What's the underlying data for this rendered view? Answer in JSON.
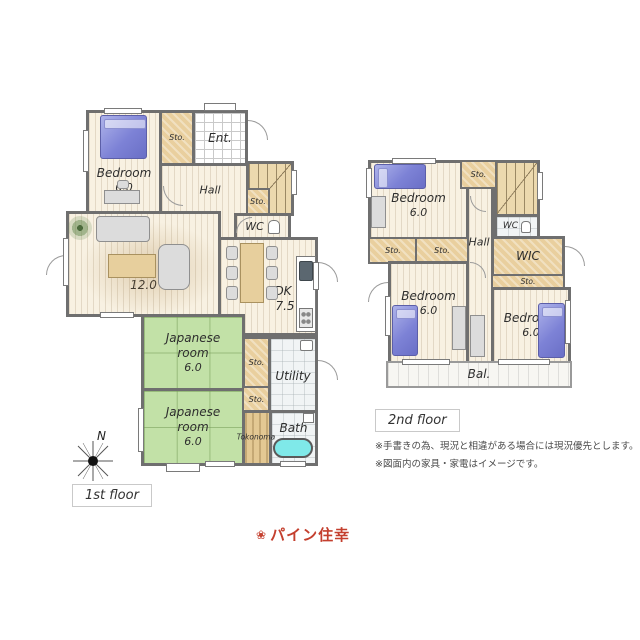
{
  "f1": {
    "label": "1st floor",
    "compass": "N",
    "bedroom_n": "Bedroom",
    "bedroom_s": "6.0",
    "sto_a": "Sto.",
    "ent": "Ent.",
    "hall": "Hall",
    "sto_b": "Sto.",
    "wc": "WC",
    "living_n": "L",
    "living_s": "12.0",
    "dk_n": "DK",
    "dk_s": "7.5",
    "jp1_l1": "Japanese",
    "jp1_l2": "room",
    "jp1_s": "6.0",
    "jp2_l1": "Japanese",
    "jp2_l2": "room",
    "jp2_s": "6.0",
    "sto_c": "Sto.",
    "sto_d": "Sto.",
    "utility": "Utility",
    "tokonoma": "Tokonoma",
    "bath": "Bath"
  },
  "f2": {
    "label": "2nd floor",
    "bedroom1_n": "Bedroom",
    "bedroom1_s": "6.0",
    "sto_a": "Sto.",
    "wc": "WC",
    "hall": "Hall",
    "sto_b": "Sto.",
    "sto_c": "Sto.",
    "wic": "WIC",
    "sto_d": "Sto.",
    "bedroom2_n": "Bedroom",
    "bedroom2_s": "6.0",
    "bedroom3_n": "Bedroom",
    "bedroom3_s": "6.0",
    "bal": "Bal."
  },
  "notes": [
    "※手書きの為、現況と相違がある場合には現況優先とします。",
    "※図面内の家具・家電はイメージです。"
  ],
  "logo": {
    "icon": "❀",
    "text": "パイン住幸"
  },
  "colors": {
    "wall": "#6f6f6f",
    "tatami": "#c2e1a7",
    "wood": "#f8f1e2",
    "closet": "#e9cf9e",
    "bed": "#7d82d6",
    "bathtub": "#7fe9e9",
    "logo": "#c43f2e"
  }
}
